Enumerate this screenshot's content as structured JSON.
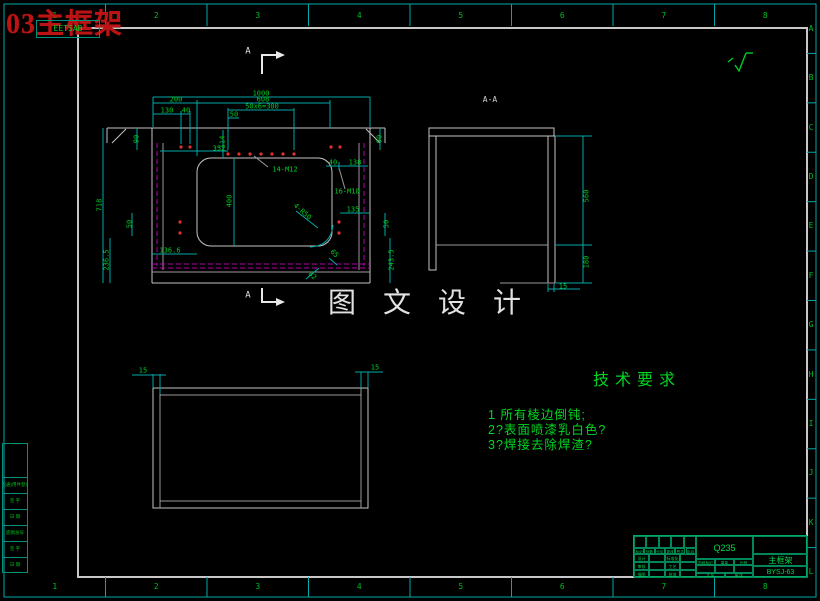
{
  "title_overlay": {
    "text": "03主框架",
    "stamp": "EETSAB"
  },
  "watermark": "图 文 设 计",
  "border": {
    "columns": [
      "1",
      "2",
      "3",
      "4",
      "5",
      "6",
      "7",
      "8"
    ],
    "rows": [
      "A",
      "B",
      "C",
      "D",
      "E",
      "F",
      "G",
      "H",
      "I",
      "J",
      "K",
      "L"
    ]
  },
  "tech_req": {
    "title": "技术要求",
    "items": [
      "1 所有棱边倒钝;",
      "2?表面喷漆乳白色?",
      "3?焊接去除焊渣?"
    ]
  },
  "labels": [
    {
      "t": "1000",
      "x": 261,
      "y": 94
    },
    {
      "t": "200",
      "x": 176,
      "y": 100
    },
    {
      "t": "608",
      "x": 263,
      "y": 100
    },
    {
      "t": "130",
      "x": 167,
      "y": 111
    },
    {
      "t": "40",
      "x": 186,
      "y": 111
    },
    {
      "t": "50x6=300",
      "x": 262,
      "y": 107
    },
    {
      "t": "50",
      "x": 234,
      "y": 115
    },
    {
      "t": "114",
      "x": 223,
      "y": 142,
      "r": -90
    },
    {
      "t": "90",
      "x": 137,
      "y": 139,
      "r": -90
    },
    {
      "t": "90",
      "x": 380,
      "y": 139,
      "r": -90
    },
    {
      "t": "352",
      "x": 219,
      "y": 149
    },
    {
      "t": "14-M12",
      "x": 285,
      "y": 170
    },
    {
      "t": "40",
      "x": 333,
      "y": 163
    },
    {
      "t": "138",
      "x": 355,
      "y": 163
    },
    {
      "t": "16-M10",
      "x": 347,
      "y": 192
    },
    {
      "t": "135",
      "x": 353,
      "y": 210
    },
    {
      "t": "718",
      "x": 100,
      "y": 205,
      "r": -90
    },
    {
      "t": "400",
      "x": 230,
      "y": 201,
      "r": -90
    },
    {
      "t": "4-R50",
      "x": 302,
      "y": 212,
      "r": 42
    },
    {
      "t": "50",
      "x": 130,
      "y": 224,
      "r": -90
    },
    {
      "t": "136.6",
      "x": 170,
      "y": 251
    },
    {
      "t": "236.5",
      "x": 107,
      "y": 260,
      "r": -90
    },
    {
      "t": "50",
      "x": 387,
      "y": 224,
      "r": -90
    },
    {
      "t": "243.5",
      "x": 392,
      "y": 260,
      "r": -90
    },
    {
      "t": "65",
      "x": 334,
      "y": 254,
      "r": 45
    },
    {
      "t": "82",
      "x": 312,
      "y": 276,
      "r": 45
    },
    {
      "t": "A-A",
      "x": 490,
      "y": 100,
      "c": "gray",
      "s": 8
    },
    {
      "t": "560",
      "x": 587,
      "y": 196,
      "r": -90
    },
    {
      "t": "180",
      "x": 587,
      "y": 262,
      "r": -90
    },
    {
      "t": "15",
      "x": 563,
      "y": 287
    },
    {
      "t": "15",
      "x": 143,
      "y": 371
    },
    {
      "t": "15",
      "x": 375,
      "y": 368
    },
    {
      "t": "A",
      "x": 248,
      "y": 52,
      "c": "white",
      "s": 9
    },
    {
      "t": "A",
      "x": 248,
      "y": 296,
      "c": "white",
      "s": 9
    }
  ],
  "title_block": {
    "material": "Q235",
    "part_name": "主框架",
    "drawing_no": "BYSJ-63",
    "header_row": [
      "标记",
      "处数",
      "分区",
      "更改文件号",
      "签名",
      "年月日"
    ],
    "sign_rows": [
      [
        "设计",
        "标准化"
      ],
      [
        "审核",
        "工艺"
      ],
      [
        "描图",
        "批准"
      ]
    ],
    "stage_row": [
      "阶段标记",
      "重量",
      "比例"
    ],
    "sheet_row": [
      "共 张",
      "第 张"
    ]
  },
  "side_strip": {
    "rows": [
      "借(通)用件登记",
      "签 字",
      "日 期",
      "底图总号",
      "签 字",
      "日 期"
    ]
  }
}
